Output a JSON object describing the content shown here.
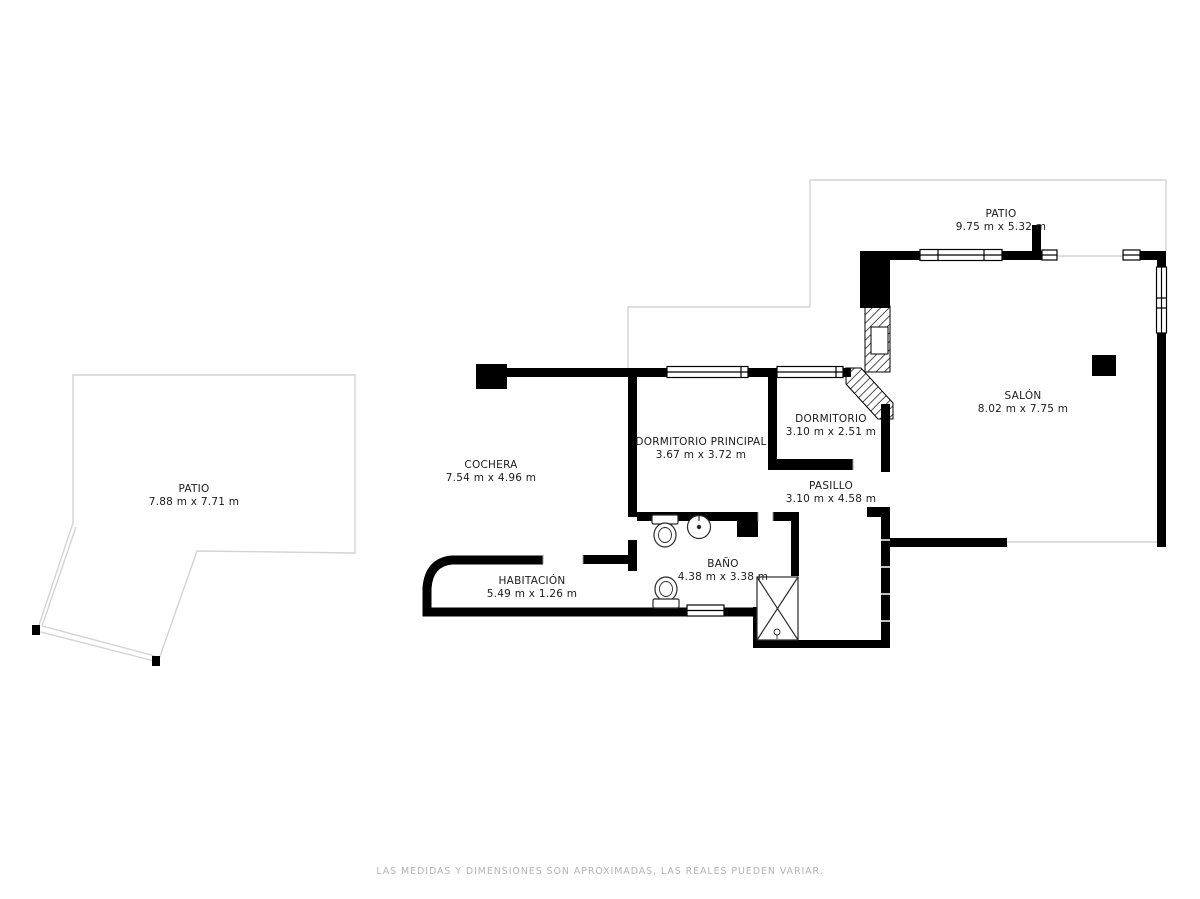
{
  "page": {
    "width": 1200,
    "height": 899,
    "background": "#ffffff"
  },
  "colors": {
    "wall": "#000000",
    "patio_outline": "#d3d3d3",
    "fixture_stroke": "#2a2a2a",
    "label_text": "#1b1b1b",
    "footer_text": "#b4b4b4"
  },
  "floorplan": {
    "rooms": [
      {
        "id": "patio-top",
        "name": "PATIO",
        "dimensions": "9.75 m x 5.32 m",
        "label_x": 1001,
        "label_y": 208
      },
      {
        "id": "salon",
        "name": "SALÓN",
        "dimensions": "8.02 m x 7.75 m",
        "label_x": 1023,
        "label_y": 390
      },
      {
        "id": "dormitorio",
        "name": "DORMITORIO",
        "dimensions": "3.10 m x 2.51 m",
        "label_x": 831,
        "label_y": 413
      },
      {
        "id": "dormitorio-principal",
        "name": "DORMITORIO PRINCIPAL",
        "dimensions": "3.67 m x 3.72 m",
        "label_x": 701,
        "label_y": 436
      },
      {
        "id": "cochera",
        "name": "COCHERA",
        "dimensions": "7.54 m x 4.96 m",
        "label_x": 491,
        "label_y": 459
      },
      {
        "id": "pasillo",
        "name": "PASILLO",
        "dimensions": "3.10 m x 4.58 m",
        "label_x": 831,
        "label_y": 480
      },
      {
        "id": "bano",
        "name": "BAÑO",
        "dimensions": "4.38 m x 3.38 m",
        "label_x": 723,
        "label_y": 558
      },
      {
        "id": "habitacion",
        "name": "HABITACIÓN",
        "dimensions": "5.49 m x 1.26 m",
        "label_x": 532,
        "label_y": 575
      },
      {
        "id": "patio-left",
        "name": "PATIO",
        "dimensions": "7.88 m x 7.71 m",
        "label_x": 194,
        "label_y": 483
      }
    ]
  },
  "footer": {
    "disclaimer": "LAS MEDIDAS Y DIMENSIONES SON APROXIMADAS, LAS REALES PUEDEN VARIAR."
  }
}
